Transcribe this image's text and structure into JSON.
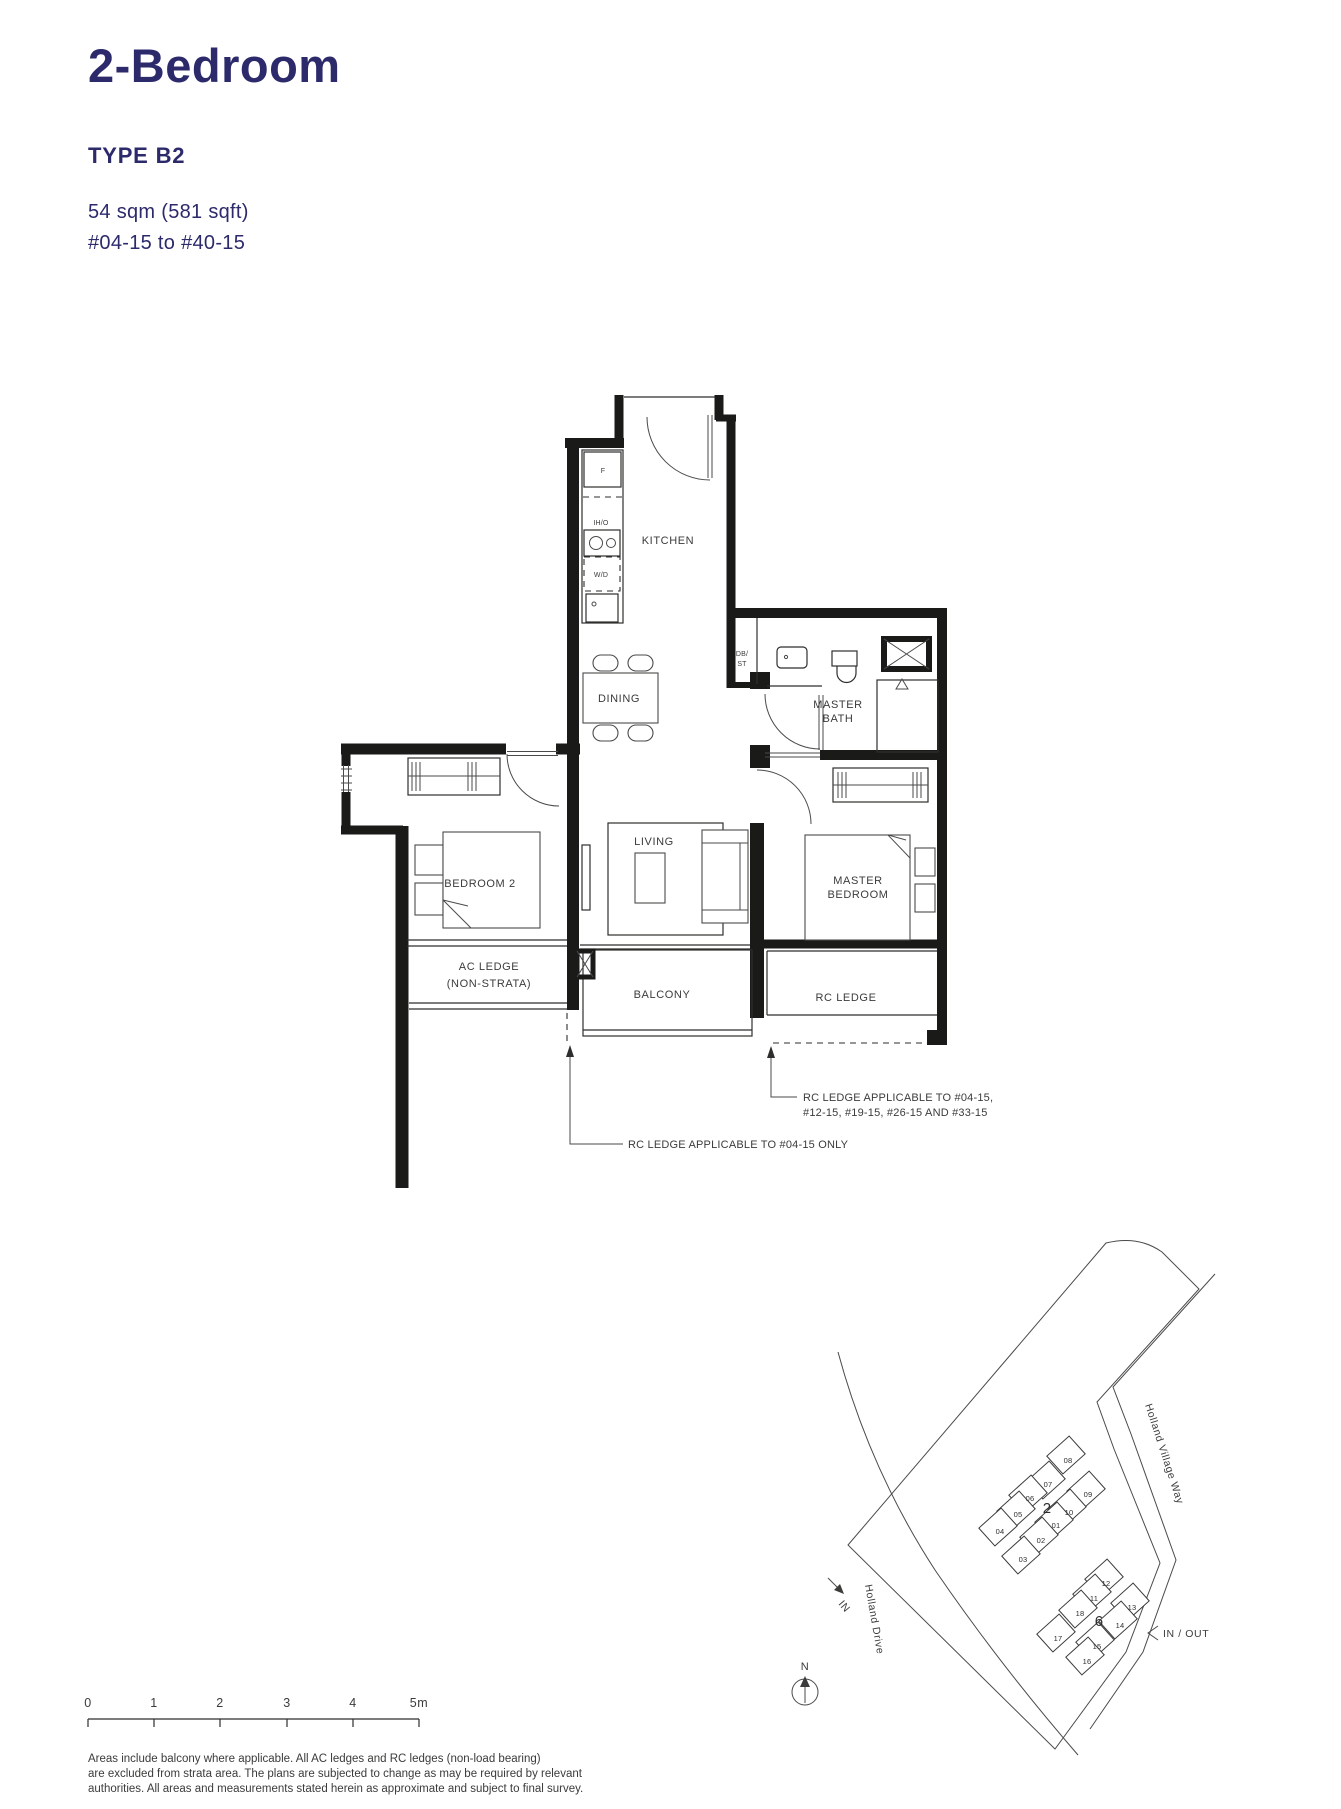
{
  "header": {
    "title": "2-Bedroom",
    "type": "TYPE B2",
    "area": "54 sqm (581 sqft)",
    "range": "#04-15 to #40-15"
  },
  "colors": {
    "heading": "#2c2a6b",
    "plan_line": "#1a1a19",
    "text": "#3b3b3a",
    "highlight": "#bcdde4"
  },
  "plan": {
    "labels": {
      "kitchen": "KITCHEN",
      "dining": "DINING",
      "living": "LIVING",
      "bedroom2": "BEDROOM 2",
      "master_line1": "MASTER",
      "master_line2": "BEDROOM",
      "bath_line1": "MASTER",
      "bath_line2": "BATH",
      "balcony": "BALCONY",
      "ac_line1": "AC LEDGE",
      "ac_line2": "(NON-STRATA)",
      "rc": "RC LEDGE",
      "db_line1": "DB/",
      "db_line2": "ST",
      "fridge": "F",
      "hob": "IH/O",
      "washer": "W/D"
    },
    "notes": {
      "multi_line1": "RC LEDGE APPLICABLE TO #04-15,",
      "multi_line2": "#12-15, #19-15, #26-15 AND #33-15",
      "single": "RC LEDGE APPLICABLE TO #04-15 ONLY"
    }
  },
  "scalebar": {
    "m0": "0",
    "m1": "1",
    "m2": "2",
    "m3": "3",
    "m4": "4",
    "m5": "5m"
  },
  "sitemap": {
    "street_ne": "Holland Village Way",
    "street_sw": "Holland Drive",
    "in_out": "IN / OUT",
    "in_label": "IN",
    "north": "N",
    "block2_label": "2",
    "block6_label": "6",
    "units2": {
      "u01": "01",
      "u02": "02",
      "u03": "03",
      "u04": "04",
      "u05": "05",
      "u06": "06",
      "u07": "07",
      "u08": "08",
      "u09": "09",
      "u10": "10"
    },
    "units6": {
      "u11": "11",
      "u12": "12",
      "u13": "13",
      "u14": "14",
      "u15": "15",
      "u16": "16",
      "u17": "17",
      "u18": "18"
    }
  },
  "disclaimer": {
    "line1": "Areas include balcony where applicable. All AC ledges and RC ledges (non-load bearing)",
    "line2": "are excluded from strata area. The plans are subjected to change as may be required by relevant",
    "line3": "authorities. All areas and measurements stated herein as approximate and subject to final survey."
  }
}
